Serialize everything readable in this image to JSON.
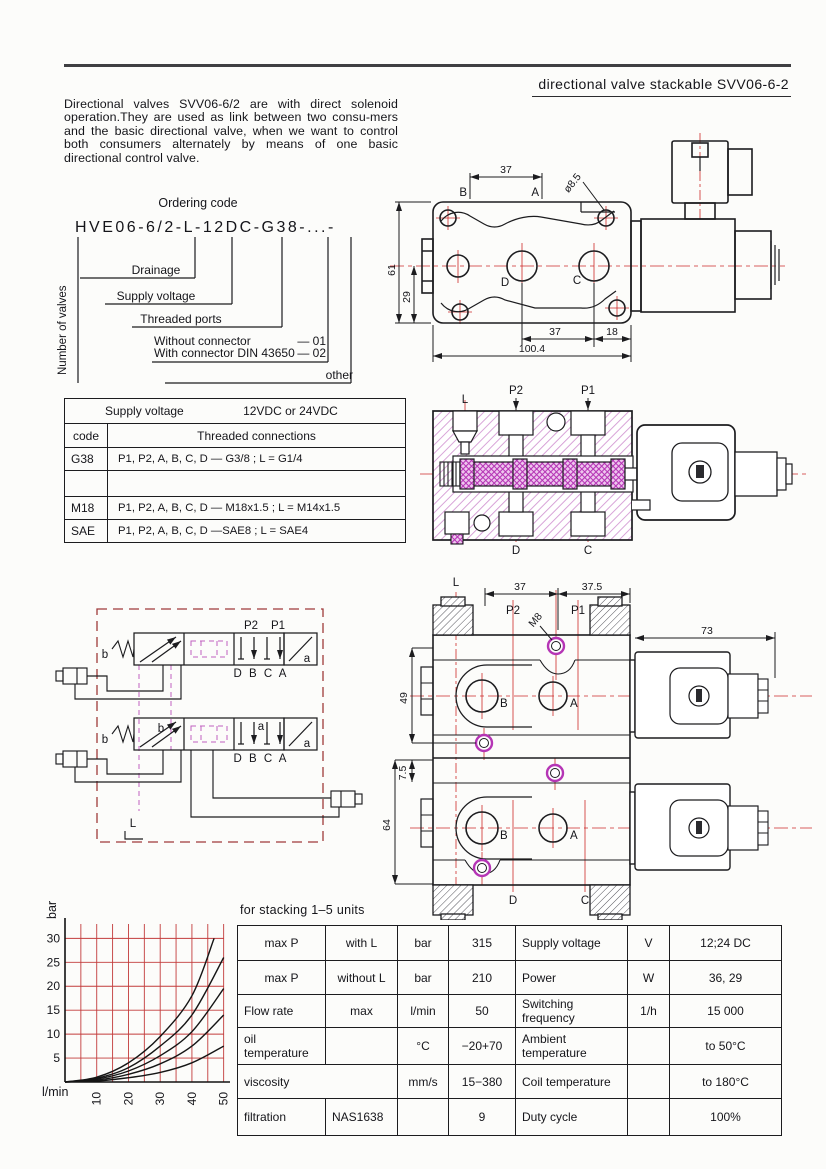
{
  "header": {
    "title": "directional  valve  stackable SVV06-6-2",
    "description": "Directional valves SVV06-6/2 are with direct solenoid operation.They are used as link between two consu-mers and the basic directional valve, when we want to control both consumers alternately by means of one basic directional control valve."
  },
  "ordering": {
    "heading": "Ordering code",
    "code": "HVE06-6/2-L-12DC-G38-...-",
    "number_of_valves": "Number of valves",
    "drainage": "Drainage",
    "supply_voltage": "Supply voltage",
    "threaded_ports": "Threaded ports",
    "without_connector": "Without connector",
    "without_code": "—  01",
    "with_connector": "With connector DIN 43650",
    "with_code": "—  02",
    "other": "other"
  },
  "voltage_table": {
    "supply_voltage_label": "Supply voltage",
    "supply_voltage_value": "12VDC or 24VDC",
    "code_header": "code",
    "connections_header": "Threaded connections",
    "rows": [
      {
        "code": "G38",
        "connections": "P1, P2, A, B, C, D — G3/8 ; L = G1/4"
      },
      {
        "code": "",
        "connections": ""
      },
      {
        "code": "M18",
        "connections": "P1, P2, A, B, C, D — M18x1.5 ; L = M14x1.5"
      },
      {
        "code": "SAE",
        "connections": "P1, P2, A, B, C, D —SAE8 ; L = SAE4"
      }
    ]
  },
  "top_drawing": {
    "label_B": "B",
    "label_A": "A",
    "label_D": "D",
    "label_C": "C",
    "dim_37_top": "37",
    "dim_dia": "ø8.5",
    "dim_61": "61",
    "dim_29": "29",
    "dim_37_bottom": "37",
    "dim_18": "18",
    "dim_100_4": "100.4"
  },
  "section_drawing": {
    "label_L": "L",
    "label_P2": "P2",
    "label_P1": "P1",
    "label_D": "D",
    "label_C": "C"
  },
  "schematic": {
    "label_P2": "P2",
    "label_P1": "P1",
    "ports_top": "D B C A",
    "ports_bottom": "D B C A",
    "label_b_outer1": "b",
    "label_a_outer1": "a",
    "label_b_outer2": "b",
    "label_a_outer2": "a",
    "label_b_inner": "b",
    "label_a_inner": "a",
    "label_L": "L"
  },
  "stack_drawing": {
    "label_L": "L",
    "label_P2": "P2",
    "label_P1": "P1",
    "label_M8": "M8",
    "label_B1": "B",
    "label_A1": "A",
    "label_B2": "B",
    "label_A2": "A",
    "label_D": "D",
    "label_C": "C",
    "dim_37": "37",
    "dim_37_5": "37.5",
    "dim_73": "73",
    "dim_49": "49",
    "dim_7_5": "7.5",
    "dim_64": "64"
  },
  "chart_data": {
    "type": "line",
    "title": "pressure drop vs flow",
    "xlabel": "l/min",
    "ylabel": "bar",
    "x_ticks": [
      10,
      20,
      30,
      40,
      50
    ],
    "y_ticks": [
      5,
      10,
      15,
      20,
      25,
      30
    ],
    "xlim": [
      0,
      52
    ],
    "ylim": [
      0,
      33
    ],
    "grid": true,
    "grid_step": 5,
    "grid_color": "#c23b3b",
    "legend": "none",
    "series": [
      {
        "name": "curve-1",
        "x": [
          0,
          10,
          20,
          30,
          40,
          47
        ],
        "y": [
          0,
          1,
          4,
          9.5,
          18,
          30
        ]
      },
      {
        "name": "curve-2",
        "x": [
          0,
          10,
          20,
          30,
          40,
          50
        ],
        "y": [
          0,
          0.8,
          3,
          7.5,
          14,
          26
        ]
      },
      {
        "name": "curve-3",
        "x": [
          0,
          10,
          20,
          30,
          40,
          50
        ],
        "y": [
          0,
          0.6,
          2.3,
          5.5,
          10.5,
          19.5
        ]
      },
      {
        "name": "curve-4",
        "x": [
          0,
          10,
          20,
          30,
          40,
          50
        ],
        "y": [
          0,
          0.4,
          1.6,
          3.8,
          7.5,
          14
        ]
      },
      {
        "name": "curve-5",
        "x": [
          0,
          10,
          20,
          30,
          40,
          50
        ],
        "y": [
          0,
          0.2,
          0.9,
          2,
          4,
          7.5
        ]
      }
    ]
  },
  "spec_table": {
    "caption": "for stacking 1–5 units",
    "rows": [
      [
        "max P",
        "with L",
        "bar",
        "315",
        "Supply voltage",
        "V",
        "12;24 DC"
      ],
      [
        "max P",
        "without L",
        "bar",
        "210",
        "Power",
        "W",
        "36, 29"
      ],
      [
        "Flow rate",
        "max",
        "l/min",
        "50",
        "Switching frequency",
        "1/h",
        "15 000"
      ],
      [
        "oil temperature",
        "",
        "°C",
        "−20+70",
        "Ambient temperature",
        "",
        "to 50°C"
      ],
      [
        "viscosity",
        "",
        "mm/s",
        "15−380",
        "Coil temperature",
        "",
        "to 180°C"
      ],
      [
        "filtration",
        "NAS1638",
        "",
        "9",
        "Duty cycle",
        "",
        "100%"
      ]
    ]
  }
}
